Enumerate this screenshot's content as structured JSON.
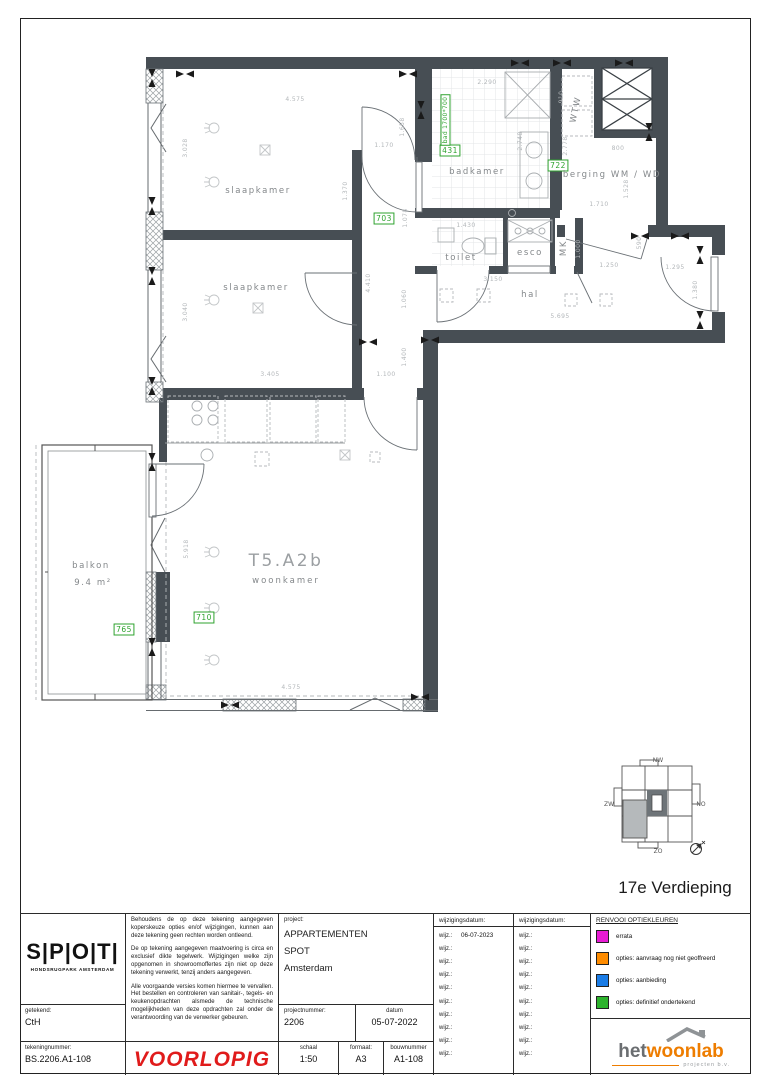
{
  "page": {
    "floor_label": "17e Verdieping"
  },
  "plan": {
    "room_labels": [
      {
        "t": "slaapkamer",
        "x": 258,
        "y": 193,
        "name": "room-label-slaapkamer-1"
      },
      {
        "t": "slaapkamer",
        "x": 256,
        "y": 290,
        "name": "room-label-slaapkamer-2"
      },
      {
        "t": "badkamer",
        "x": 477,
        "y": 174,
        "name": "room-label-badkamer"
      },
      {
        "t": "toilet",
        "x": 461,
        "y": 260,
        "name": "room-label-toilet"
      },
      {
        "t": "esco",
        "x": 530,
        "y": 255,
        "name": "room-label-esco"
      },
      {
        "t": "MK",
        "x": 566,
        "y": 248,
        "r": -90,
        "name": "room-label-mk"
      },
      {
        "t": "WTW",
        "x": 578,
        "y": 110,
        "r": -78,
        "name": "room-label-wtw"
      },
      {
        "t": "berging WM / WD",
        "x": 612,
        "y": 177,
        "name": "room-label-berging"
      },
      {
        "t": "hal",
        "x": 530,
        "y": 297,
        "name": "room-label-hal"
      },
      {
        "t": "balkon",
        "x": 91,
        "y": 568,
        "name": "room-label-balkon"
      },
      {
        "t": "9.4  m²",
        "x": 93,
        "y": 585,
        "name": "balkon-area-label"
      }
    ],
    "unit_labels": [
      {
        "t": "T5.A2b",
        "x": 286,
        "y": 566,
        "cls": "unit",
        "name": "unit-code-label"
      },
      {
        "t": "woonkamer",
        "x": 286,
        "y": 583,
        "cls": "unitroom",
        "name": "room-label-woonkamer"
      }
    ],
    "option_labels": [
      {
        "t": "703",
        "x": 384,
        "y": 221,
        "name": "option-703"
      },
      {
        "t": "431",
        "x": 450,
        "y": 153,
        "name": "option-431"
      },
      {
        "t": "722",
        "x": 558,
        "y": 168,
        "name": "option-722"
      },
      {
        "t": "765",
        "x": 124,
        "y": 632,
        "name": "option-765"
      },
      {
        "t": "710",
        "x": 204,
        "y": 620,
        "name": "option-710"
      },
      {
        "t": "bad 1700*700",
        "x": 447,
        "y": 120,
        "r": -90,
        "cls": "optsmall",
        "name": "option-bad-1700x700"
      }
    ],
    "dim_labels": [
      {
        "t": "4.575",
        "x": 295,
        "y": 101
      },
      {
        "t": "3.028",
        "x": 187,
        "y": 148,
        "r": -90
      },
      {
        "t": "1.170",
        "x": 384,
        "y": 147
      },
      {
        "t": "1.658",
        "x": 404,
        "y": 127,
        "r": -90
      },
      {
        "t": "1.370",
        "x": 347,
        "y": 191,
        "r": -90
      },
      {
        "t": "1.078",
        "x": 407,
        "y": 218,
        "r": -90
      },
      {
        "t": "2.290",
        "x": 487,
        "y": 84
      },
      {
        "t": "2.748",
        "x": 522,
        "y": 141,
        "r": -90
      },
      {
        "t": "910",
        "x": 563,
        "y": 97,
        "r": -90
      },
      {
        "t": "2.778",
        "x": 567,
        "y": 146,
        "r": -90
      },
      {
        "t": "800",
        "x": 618,
        "y": 150
      },
      {
        "t": "1.528",
        "x": 628,
        "y": 189,
        "r": -90
      },
      {
        "t": "1.710",
        "x": 599,
        "y": 206
      },
      {
        "t": "1.430",
        "x": 466,
        "y": 227
      },
      {
        "t": "3.150",
        "x": 493,
        "y": 281
      },
      {
        "t": "1.000",
        "x": 580,
        "y": 249,
        "r": -90
      },
      {
        "t": "1.250",
        "x": 609,
        "y": 267
      },
      {
        "t": "590",
        "x": 641,
        "y": 243,
        "r": -90
      },
      {
        "t": "5.695",
        "x": 560,
        "y": 318
      },
      {
        "t": "1.295",
        "x": 675,
        "y": 269
      },
      {
        "t": "1.380",
        "x": 697,
        "y": 290,
        "r": -90
      },
      {
        "t": "3.040",
        "x": 187,
        "y": 312,
        "r": -90
      },
      {
        "t": "4.410",
        "x": 370,
        "y": 283,
        "r": -90
      },
      {
        "t": "1.060",
        "x": 406,
        "y": 299,
        "r": -90
      },
      {
        "t": "3.405",
        "x": 270,
        "y": 376
      },
      {
        "t": "1.100",
        "x": 386,
        "y": 376
      },
      {
        "t": "1.400",
        "x": 406,
        "y": 357,
        "r": -90
      },
      {
        "t": "5.918",
        "x": 188,
        "y": 549,
        "r": -90
      },
      {
        "t": "4.575",
        "x": 291,
        "y": 689
      }
    ]
  },
  "keyplan": {
    "labels": [
      {
        "t": "NW",
        "x": 658,
        "y": 762
      },
      {
        "t": "ZW",
        "x": 609,
        "y": 806
      },
      {
        "t": "NO",
        "x": 701,
        "y": 806
      },
      {
        "t": "ZO",
        "x": 658,
        "y": 853
      }
    ]
  },
  "titleblock": {
    "logo": {
      "text": "S|P|O|T|",
      "subtitle": "HONDSRUGPARK AMSTERDAM"
    },
    "getekend": {
      "label": "getekend:",
      "value": "CtH"
    },
    "tekeningnummer": {
      "label": "tekeningnummer:",
      "value": "BS.2206.A1-108"
    },
    "disclaimer": {
      "p1": "Behoudens de op deze tekening aangegeven koperskeuze opties en/of wijzigingen, kunnen aan deze tekening geen rechten worden ontleend.",
      "p2": "De op tekening aangegeven maatvoering is circa en exclusief dikte tegelwerk. Wijzigingen welke zijn opgenomen in showroomoffertes zijn niet op deze tekening verwerkt, tenzij anders aangegeven.",
      "p3": "Alle voorgaande versies komen hiermee te vervallen. Het bestellen en controleren van sanitair-, tegels- en keukenopdrachten alsmede de technische mogelijkheden van deze opdrachten zal onder de verantwoording van de verwerker gebeuren."
    },
    "voorlopig": "VOORLOPIG",
    "project": {
      "label": "project:",
      "name": "APPARTEMENTEN",
      "name2": "SPOT",
      "city": "Amsterdam"
    },
    "projectnummer": {
      "label": "projectnummer:",
      "value": "2206"
    },
    "datum": {
      "label": "datum",
      "value": "05-07-2022"
    },
    "schaal": {
      "label": "schaal",
      "value": "1:50"
    },
    "formaat": {
      "label": "formaat:",
      "value": "A3"
    },
    "bouwnummer": {
      "label": "bouwnummer",
      "value": "A1-108"
    },
    "wijz1": {
      "header": "wijzigingsdatum:",
      "row_label": "wijz.:",
      "rows": [
        "06-07-2023",
        "",
        "",
        "",
        "",
        "",
        "",
        "",
        "",
        ""
      ]
    },
    "wijz2": {
      "header": "wijzigingsdatum:",
      "row_label": "wijz.:",
      "rows": [
        "",
        "",
        "",
        "",
        "",
        "",
        "",
        "",
        "",
        ""
      ]
    },
    "renvooi": {
      "title": "RENVOOI OPTIEKLEUREN",
      "items": [
        {
          "color": "#e81bd4",
          "label": "errata"
        },
        {
          "color": "#ff8c00",
          "label": "opties: aanvraag nog niet geoffreerd"
        },
        {
          "color": "#1a7ce6",
          "label": "opties: aanbieding"
        },
        {
          "color": "#2db32d",
          "label": "opties: definitief ondertekend"
        }
      ]
    },
    "hetwoonlab": {
      "part1": "het",
      "part2": "woonlab",
      "subtitle": "projecten b.v."
    }
  }
}
